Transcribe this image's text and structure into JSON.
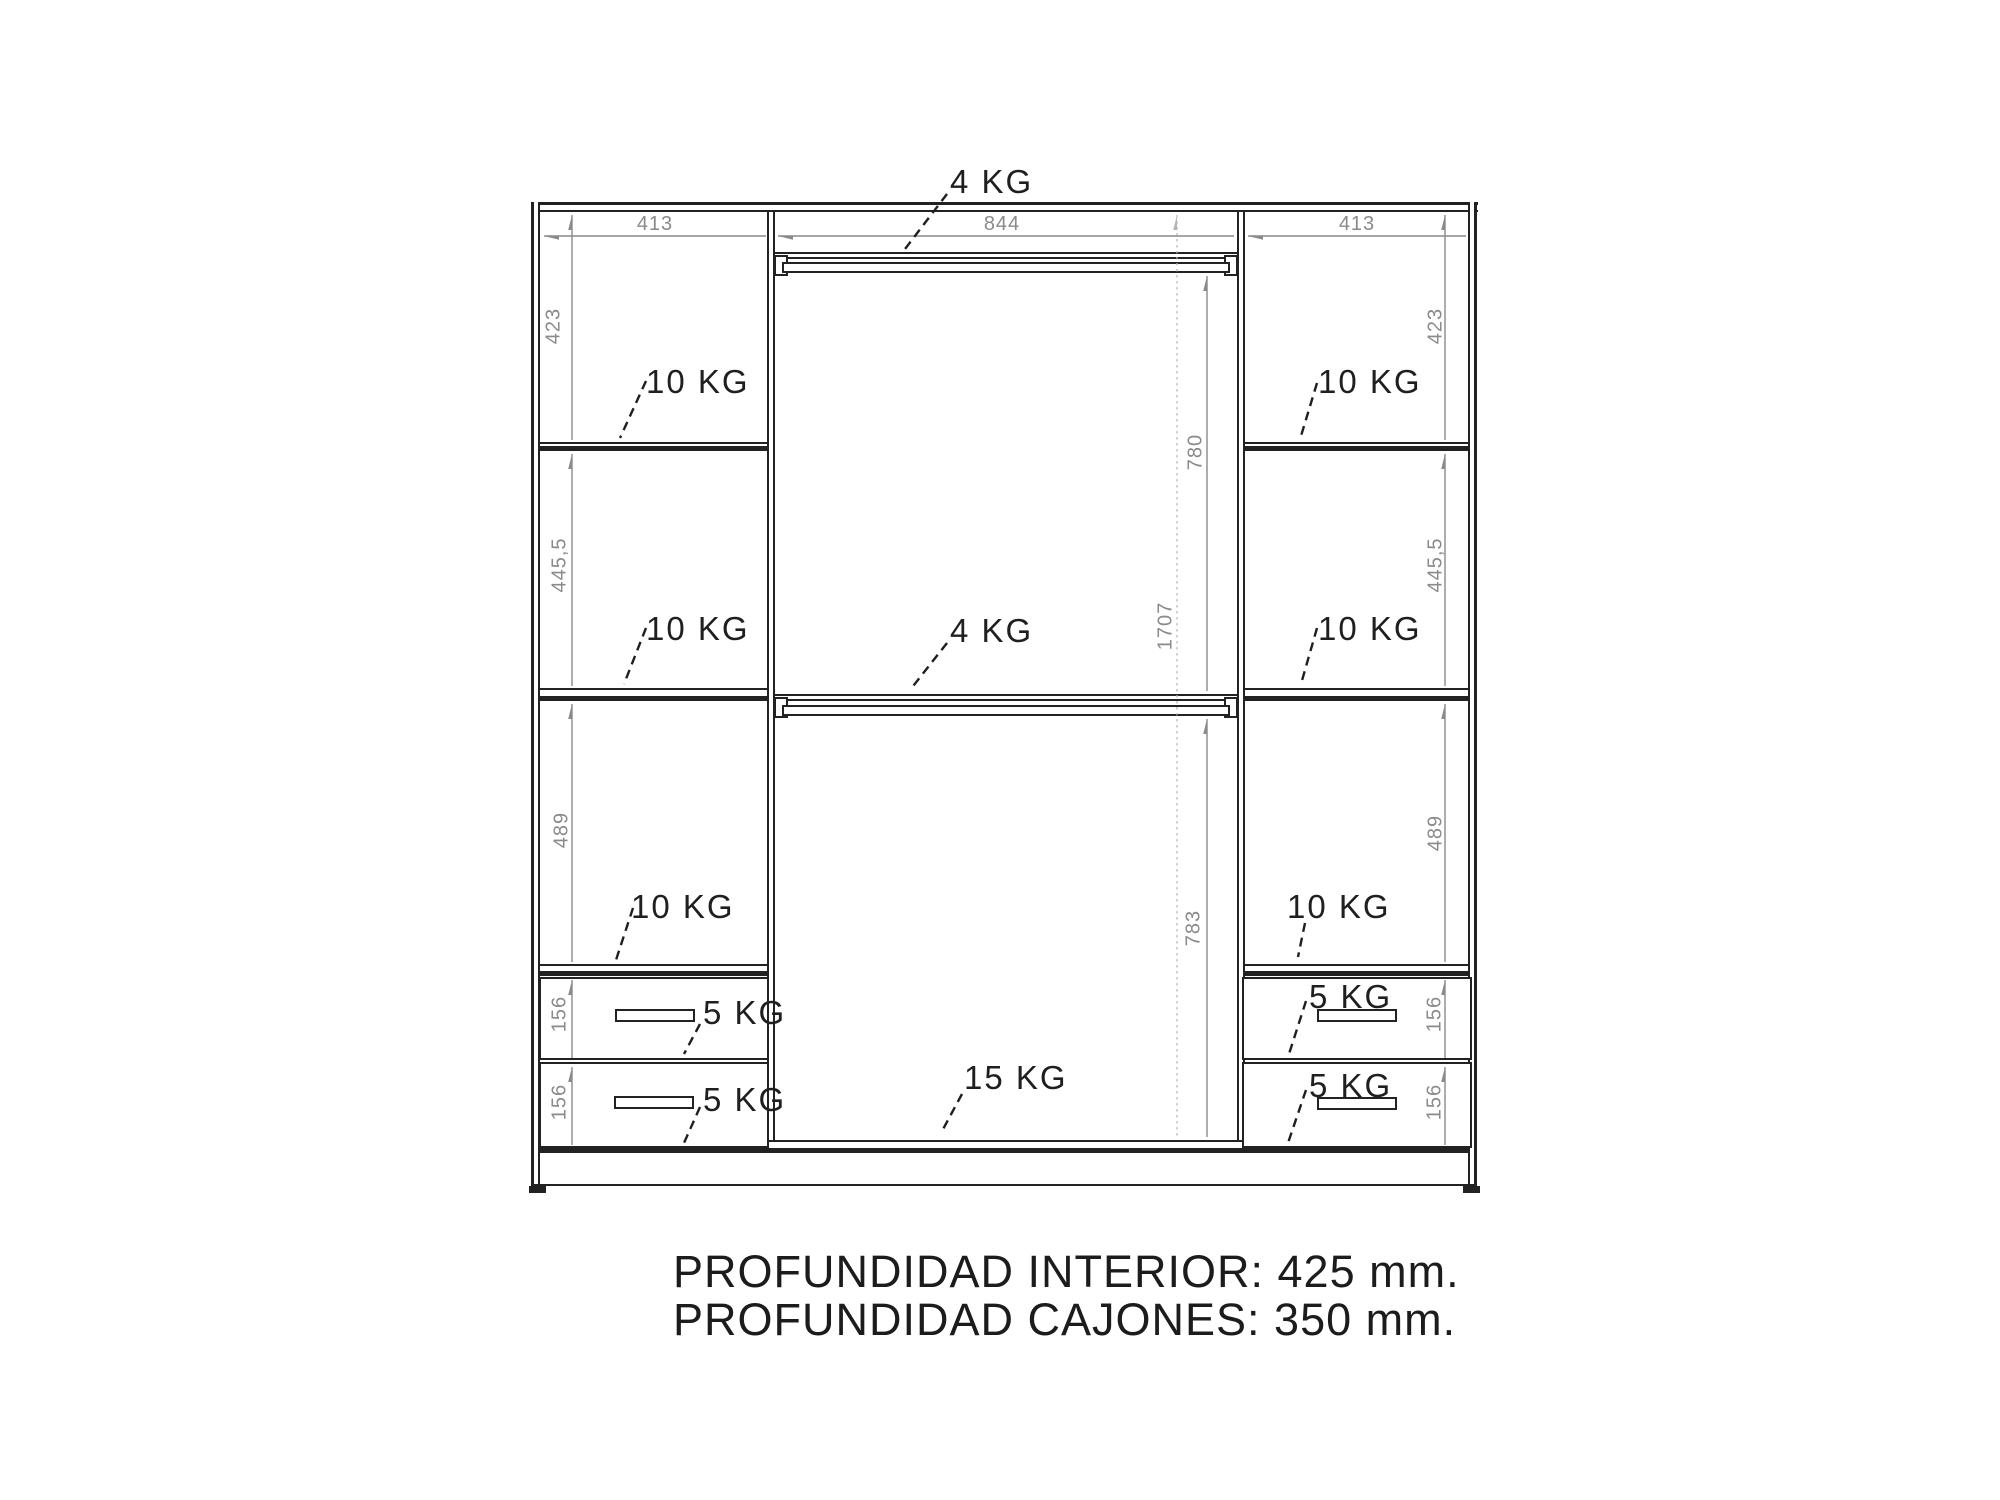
{
  "drawing": {
    "type": "wardrobe-interior-technical-drawing",
    "footer": {
      "line1": "PROFUNDIDAD INTERIOR: 425 mm.",
      "line2": "PROFUNDIDAD CAJONES: 350 mm."
    },
    "dims": {
      "top": [
        "413",
        "844",
        "413"
      ],
      "left_column": [
        "423",
        "445,5",
        "489",
        "156",
        "156"
      ],
      "middle_column": [
        "780",
        "1707",
        "783"
      ],
      "right_column": [
        "423",
        "445,5",
        "489",
        "156",
        "156"
      ]
    },
    "loads": {
      "rail_top": "4 KG",
      "rail_middle": "4 KG",
      "base": "15 KG",
      "left_shelves": [
        "10 KG",
        "10 KG",
        "10 KG"
      ],
      "right_shelves": [
        "10 KG",
        "10 KG",
        "10 KG"
      ],
      "left_drawers": [
        "5 KG",
        "5 KG"
      ],
      "right_drawers": [
        "5 KG",
        "5 KG"
      ]
    },
    "colors": {
      "line": "#222222",
      "dimension": "#8a8a8a",
      "dimension_light": "#b5b5b5",
      "text": "#1f1f1f",
      "background": "#ffffff"
    }
  }
}
